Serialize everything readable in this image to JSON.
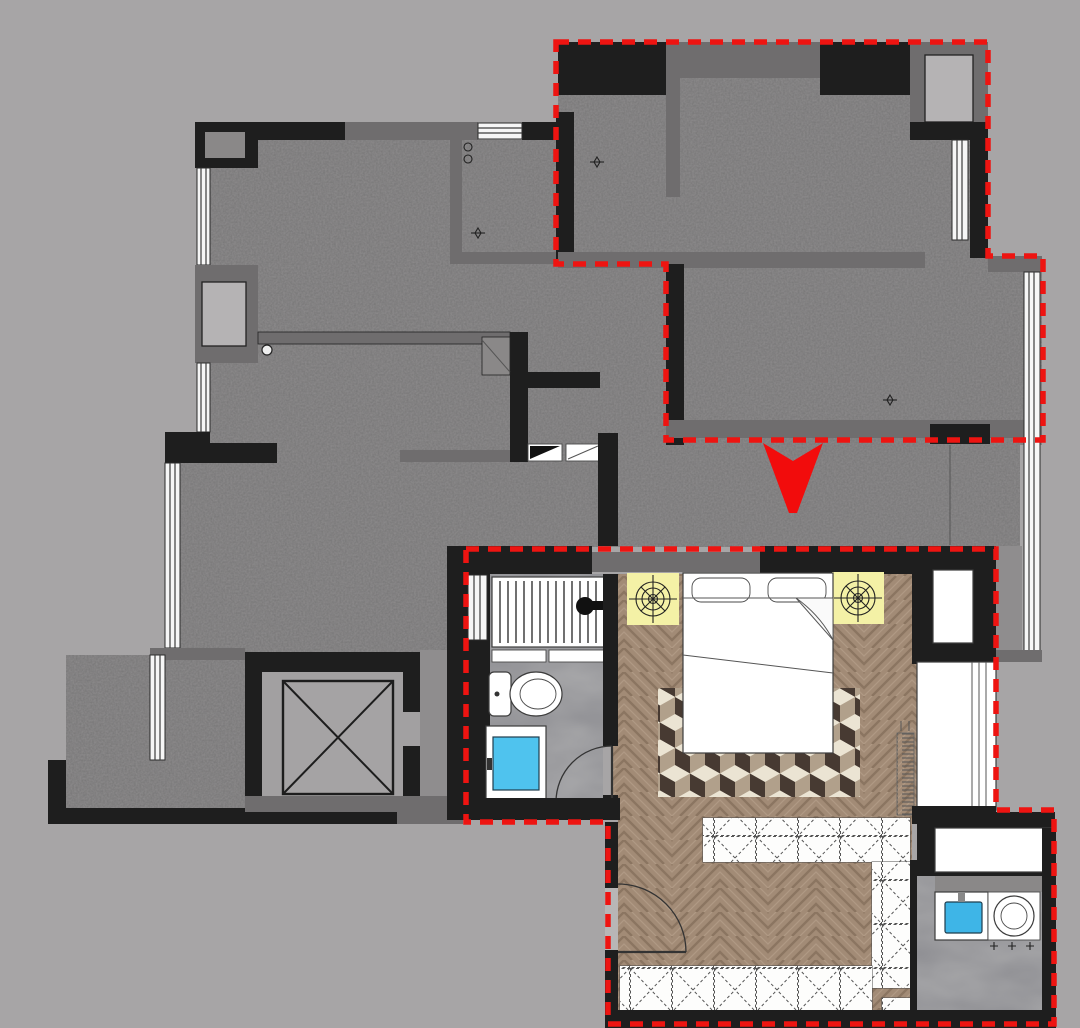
{
  "scene": {
    "title": "apartment-floor-plan-with-master-suite-detail",
    "type": "floor-plan-diagram",
    "annotation": {
      "arrow_direction": "down",
      "highlight_style": "red-dashed-outline",
      "highlighted_regions": [
        "master-suite-on-overall-plan",
        "master-suite-detail-plan"
      ]
    }
  },
  "colors": {
    "bg": "#a7a5a6",
    "floor": "#8f8d8e",
    "floor_light": "#a2a0a1",
    "wall_dark": "#1e1e1e",
    "wall_grey": "#6f6d6e",
    "wall_light": "#8a8888",
    "white": "#f6f6f6",
    "stroke": "#2b2b2b",
    "window_line": "#3d3d3d",
    "red": "#ee1411",
    "arrow_red": "#f20c0c",
    "yellow": "#f4f1a6",
    "wood": "#a28b76",
    "marble": "#a8a8aa",
    "glass": "#4fc3ee",
    "sink": "#3eb5e7",
    "rug_dark": "#473a32",
    "rug_cream": "#ebe4d3",
    "rug_tan": "#b1a08b"
  },
  "elements": {
    "overall_plan": [
      "exterior-walls",
      "interior-walls",
      "window-bays",
      "balcony",
      "elevator-shaft",
      "entry-foyer",
      "compass-marks"
    ],
    "detail_plan": [
      "bathroom-shower",
      "toilet",
      "blue-glass-door",
      "double-bed",
      "pillows",
      "ceiling-light-symbols",
      "cube-pattern-rug",
      "herringbone-wood-floor",
      "sliding-wardrobe",
      "walk-in-closet-cabinets",
      "vanity-sink",
      "round-toilet",
      "door-swing-arcs",
      "towel-radiator"
    ]
  }
}
